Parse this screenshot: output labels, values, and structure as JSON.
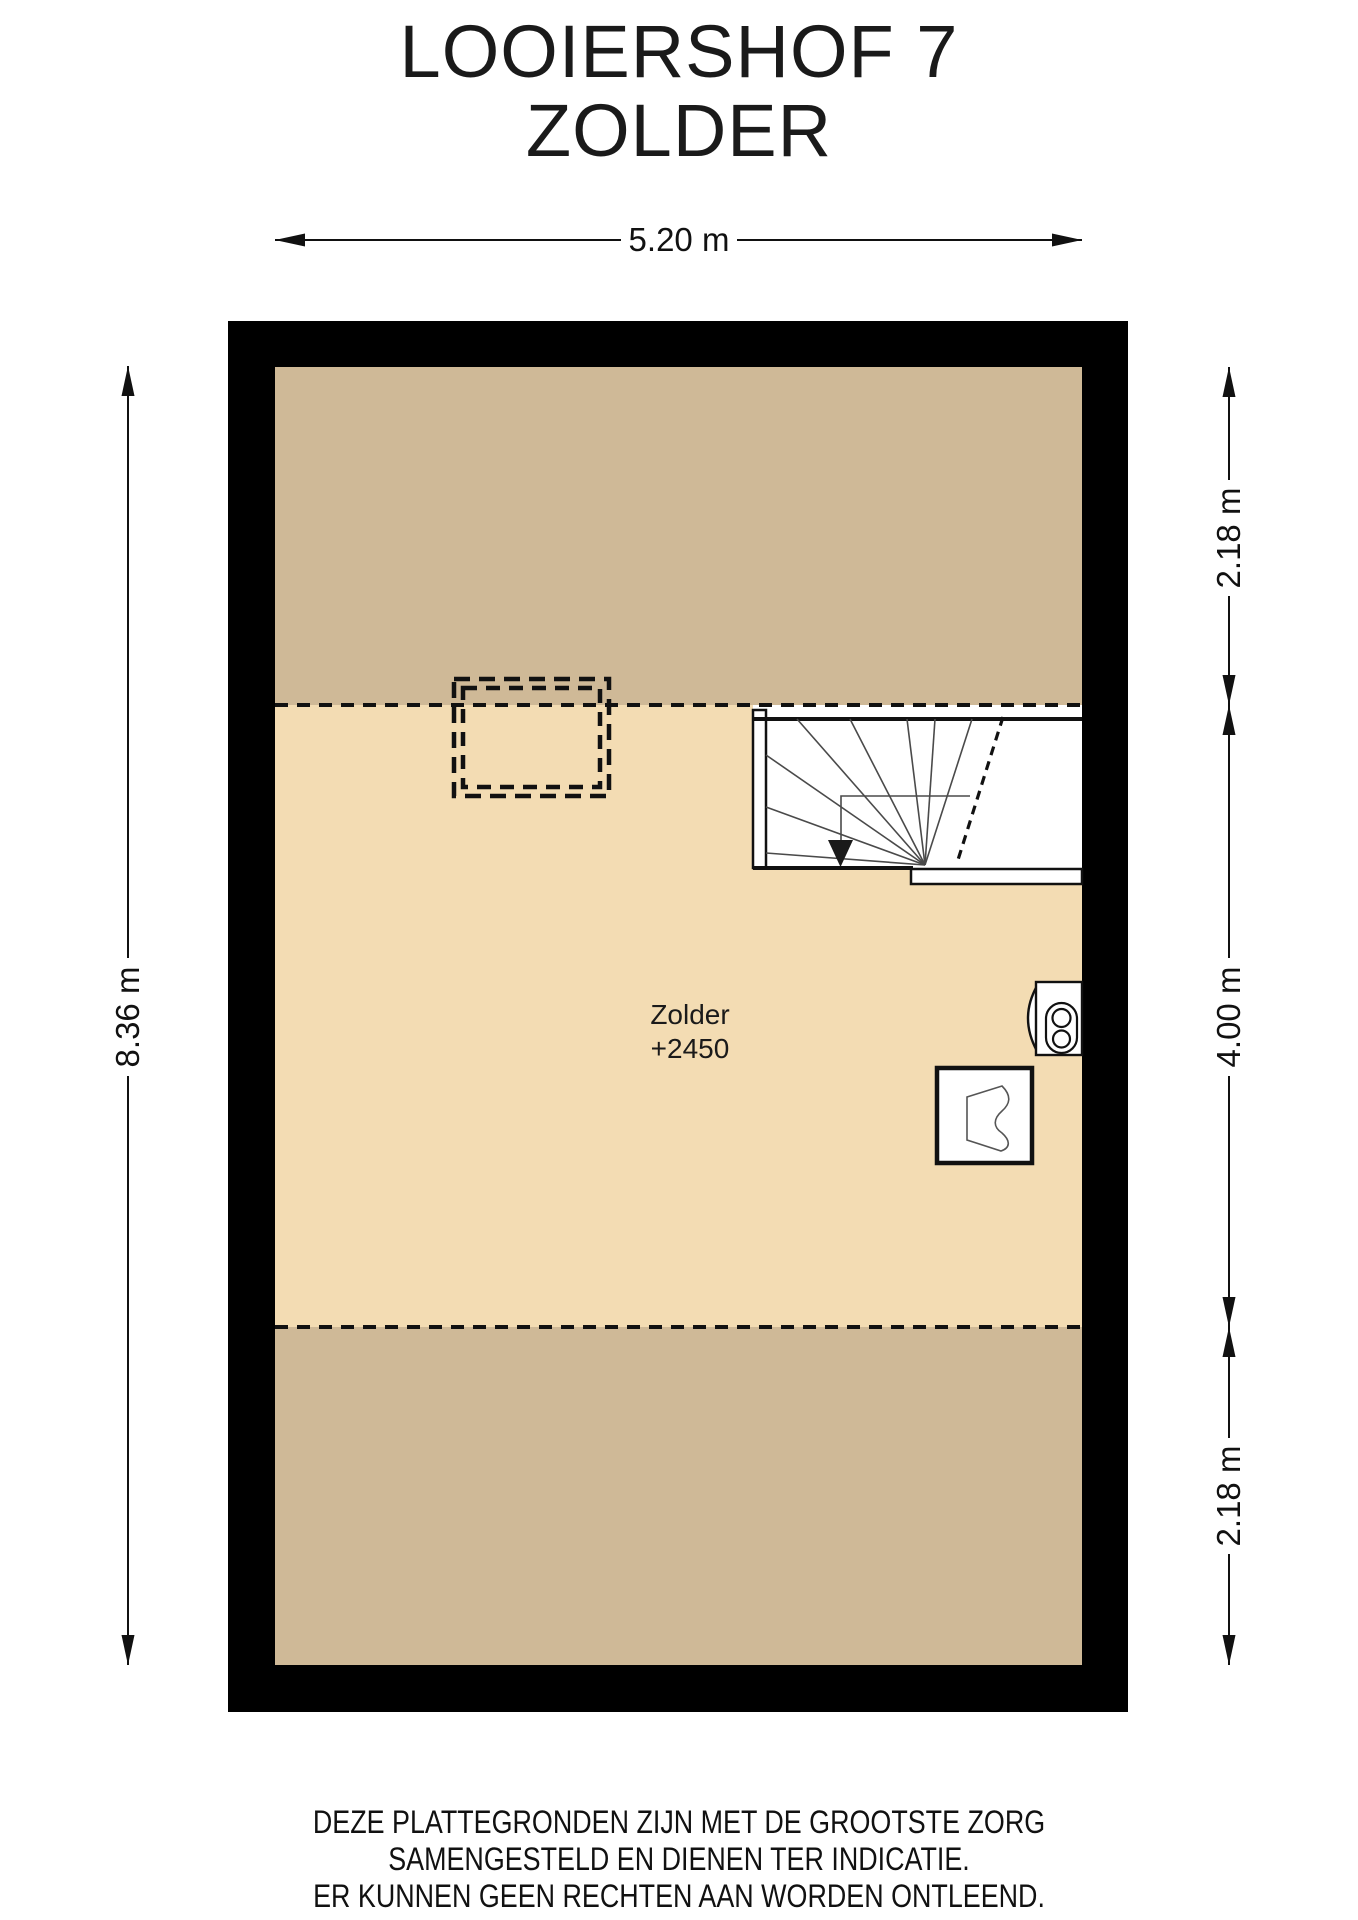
{
  "title": {
    "line1": "LOOIERSHOF 7",
    "line2": "ZOLDER"
  },
  "dimensions": {
    "top": "5.20 m",
    "left": "8.36 m",
    "right_top": "2.18 m",
    "right_middle": "4.00 m",
    "right_bottom": "2.18 m"
  },
  "room": {
    "name": "Zolder",
    "level": "+2450"
  },
  "footer": {
    "lines": [
      "DEZE PLATTEGRONDEN ZIJN MET DE GROOTSTE ZORG",
      "SAMENGESTELD EN DIENEN TER INDICATIE.",
      "ER KUNNEN GEEN RECHTEN AAN WORDEN ONTLEEND.",
      "© WWW.DROOMHUIS360.NL"
    ]
  },
  "colors": {
    "wall": "#000000",
    "floor_light": "#f3dcb3",
    "floor_dark": "#cfb997",
    "line": "#111111",
    "background": "#ffffff"
  },
  "icons": {
    "staircase": "winder-staircase-down",
    "boiler": "boiler-unit",
    "ventilation": "mechanical-ventilation-unit",
    "skylight": "skylight-dashed-outline"
  }
}
